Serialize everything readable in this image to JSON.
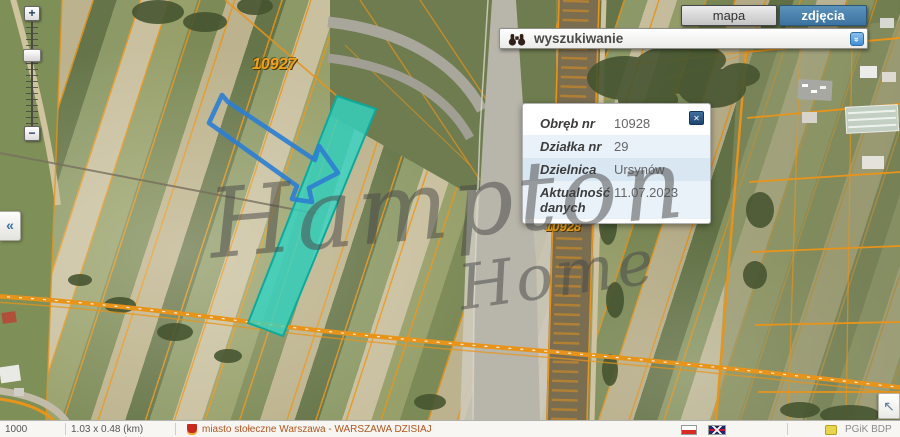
{
  "tabs": {
    "mapa": "mapa",
    "zdjecia": "zdjęcia"
  },
  "search": {
    "label": "wyszukiwanie",
    "toggle_glyph": "»"
  },
  "zoom_control": {
    "in": "+",
    "out": "−",
    "collapse": "«"
  },
  "corner": {
    "arrow": "↖"
  },
  "popup": {
    "close_glyph": "✕",
    "rows": [
      {
        "label": "Obręb nr",
        "value": "10928"
      },
      {
        "label": "Działka nr",
        "value": "29"
      },
      {
        "label": "Dzielnica",
        "value": "Ursynów"
      },
      {
        "label": "Aktualność danych",
        "value": "11.07.2023"
      }
    ]
  },
  "map": {
    "parcel_labels": [
      {
        "text": "10927"
      },
      {
        "text": "10928"
      }
    ],
    "watermark": {
      "line1": "Hampton",
      "line2": "Home"
    },
    "colors": {
      "cadastral_orange": "#e8941a",
      "highlight_teal": "#2fd6c6",
      "sketch_blue": "#2e7fd0",
      "active_tab_blue": "#4680ac"
    }
  },
  "statusbar": {
    "scale": "1000",
    "extent": "1.03 x 0.48 (km)",
    "attribution": "miasto stołeczne Warszawa - WARSZAWA DZISIAJ",
    "resource": "PGiK BDP"
  }
}
